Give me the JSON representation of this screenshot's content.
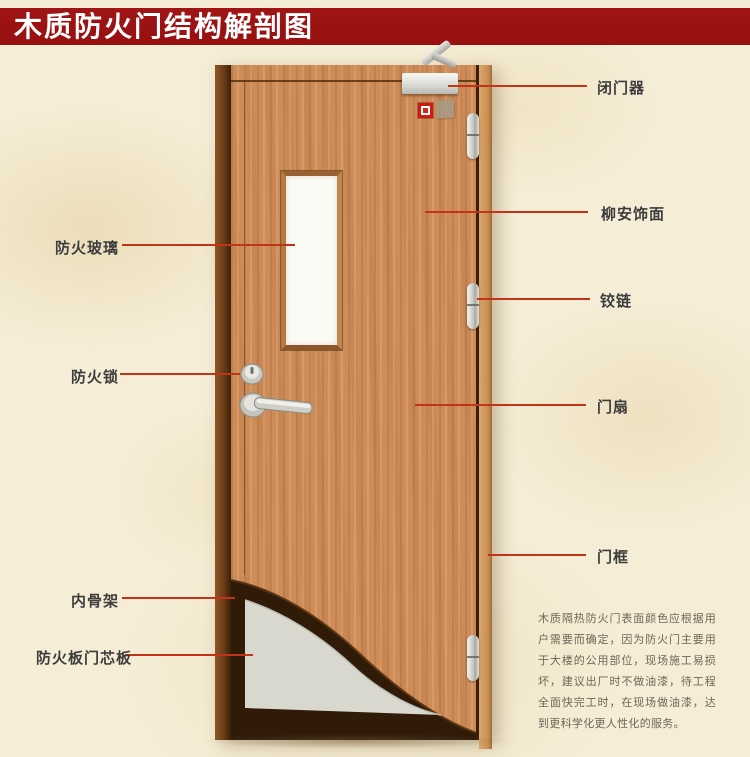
{
  "title": "木质防火门结构解剖图",
  "colors": {
    "banner_red": "#9d1212",
    "background_cream": "#f5edd6",
    "leader_line_red": "#c23418",
    "label_text": "#3d3d3d",
    "door_wood": "#cd8c58",
    "frame_dark_wood": "#6b3d18",
    "inner_skeleton_dark": "#2f1b08",
    "core_board_gray": "#d8d8ce",
    "glass_white": "#fbfbf6"
  },
  "labels": {
    "left": [
      {
        "id": "fire-glass",
        "text": "防火玻璃"
      },
      {
        "id": "fire-lock",
        "text": "防火锁"
      },
      {
        "id": "inner-skeleton",
        "text": "内骨架"
      },
      {
        "id": "fire-board-core",
        "text": "防火板门芯板"
      }
    ],
    "right": [
      {
        "id": "door-closer",
        "text": "闭门器"
      },
      {
        "id": "lauan-veneer",
        "text": "柳安饰面"
      },
      {
        "id": "hinge",
        "text": "铰链"
      },
      {
        "id": "door-leaf",
        "text": "门扇"
      },
      {
        "id": "door-frame",
        "text": "门框"
      }
    ]
  },
  "description": "木质隔热防火门表面颜色应根据用户需要而确定，因为防火门主要用于大楼的公用部位，现场施工易损坏，建议出厂时不做油漆，待工程全面快完工时，在现场做油漆，达到更科学化更人性化的服务。"
}
